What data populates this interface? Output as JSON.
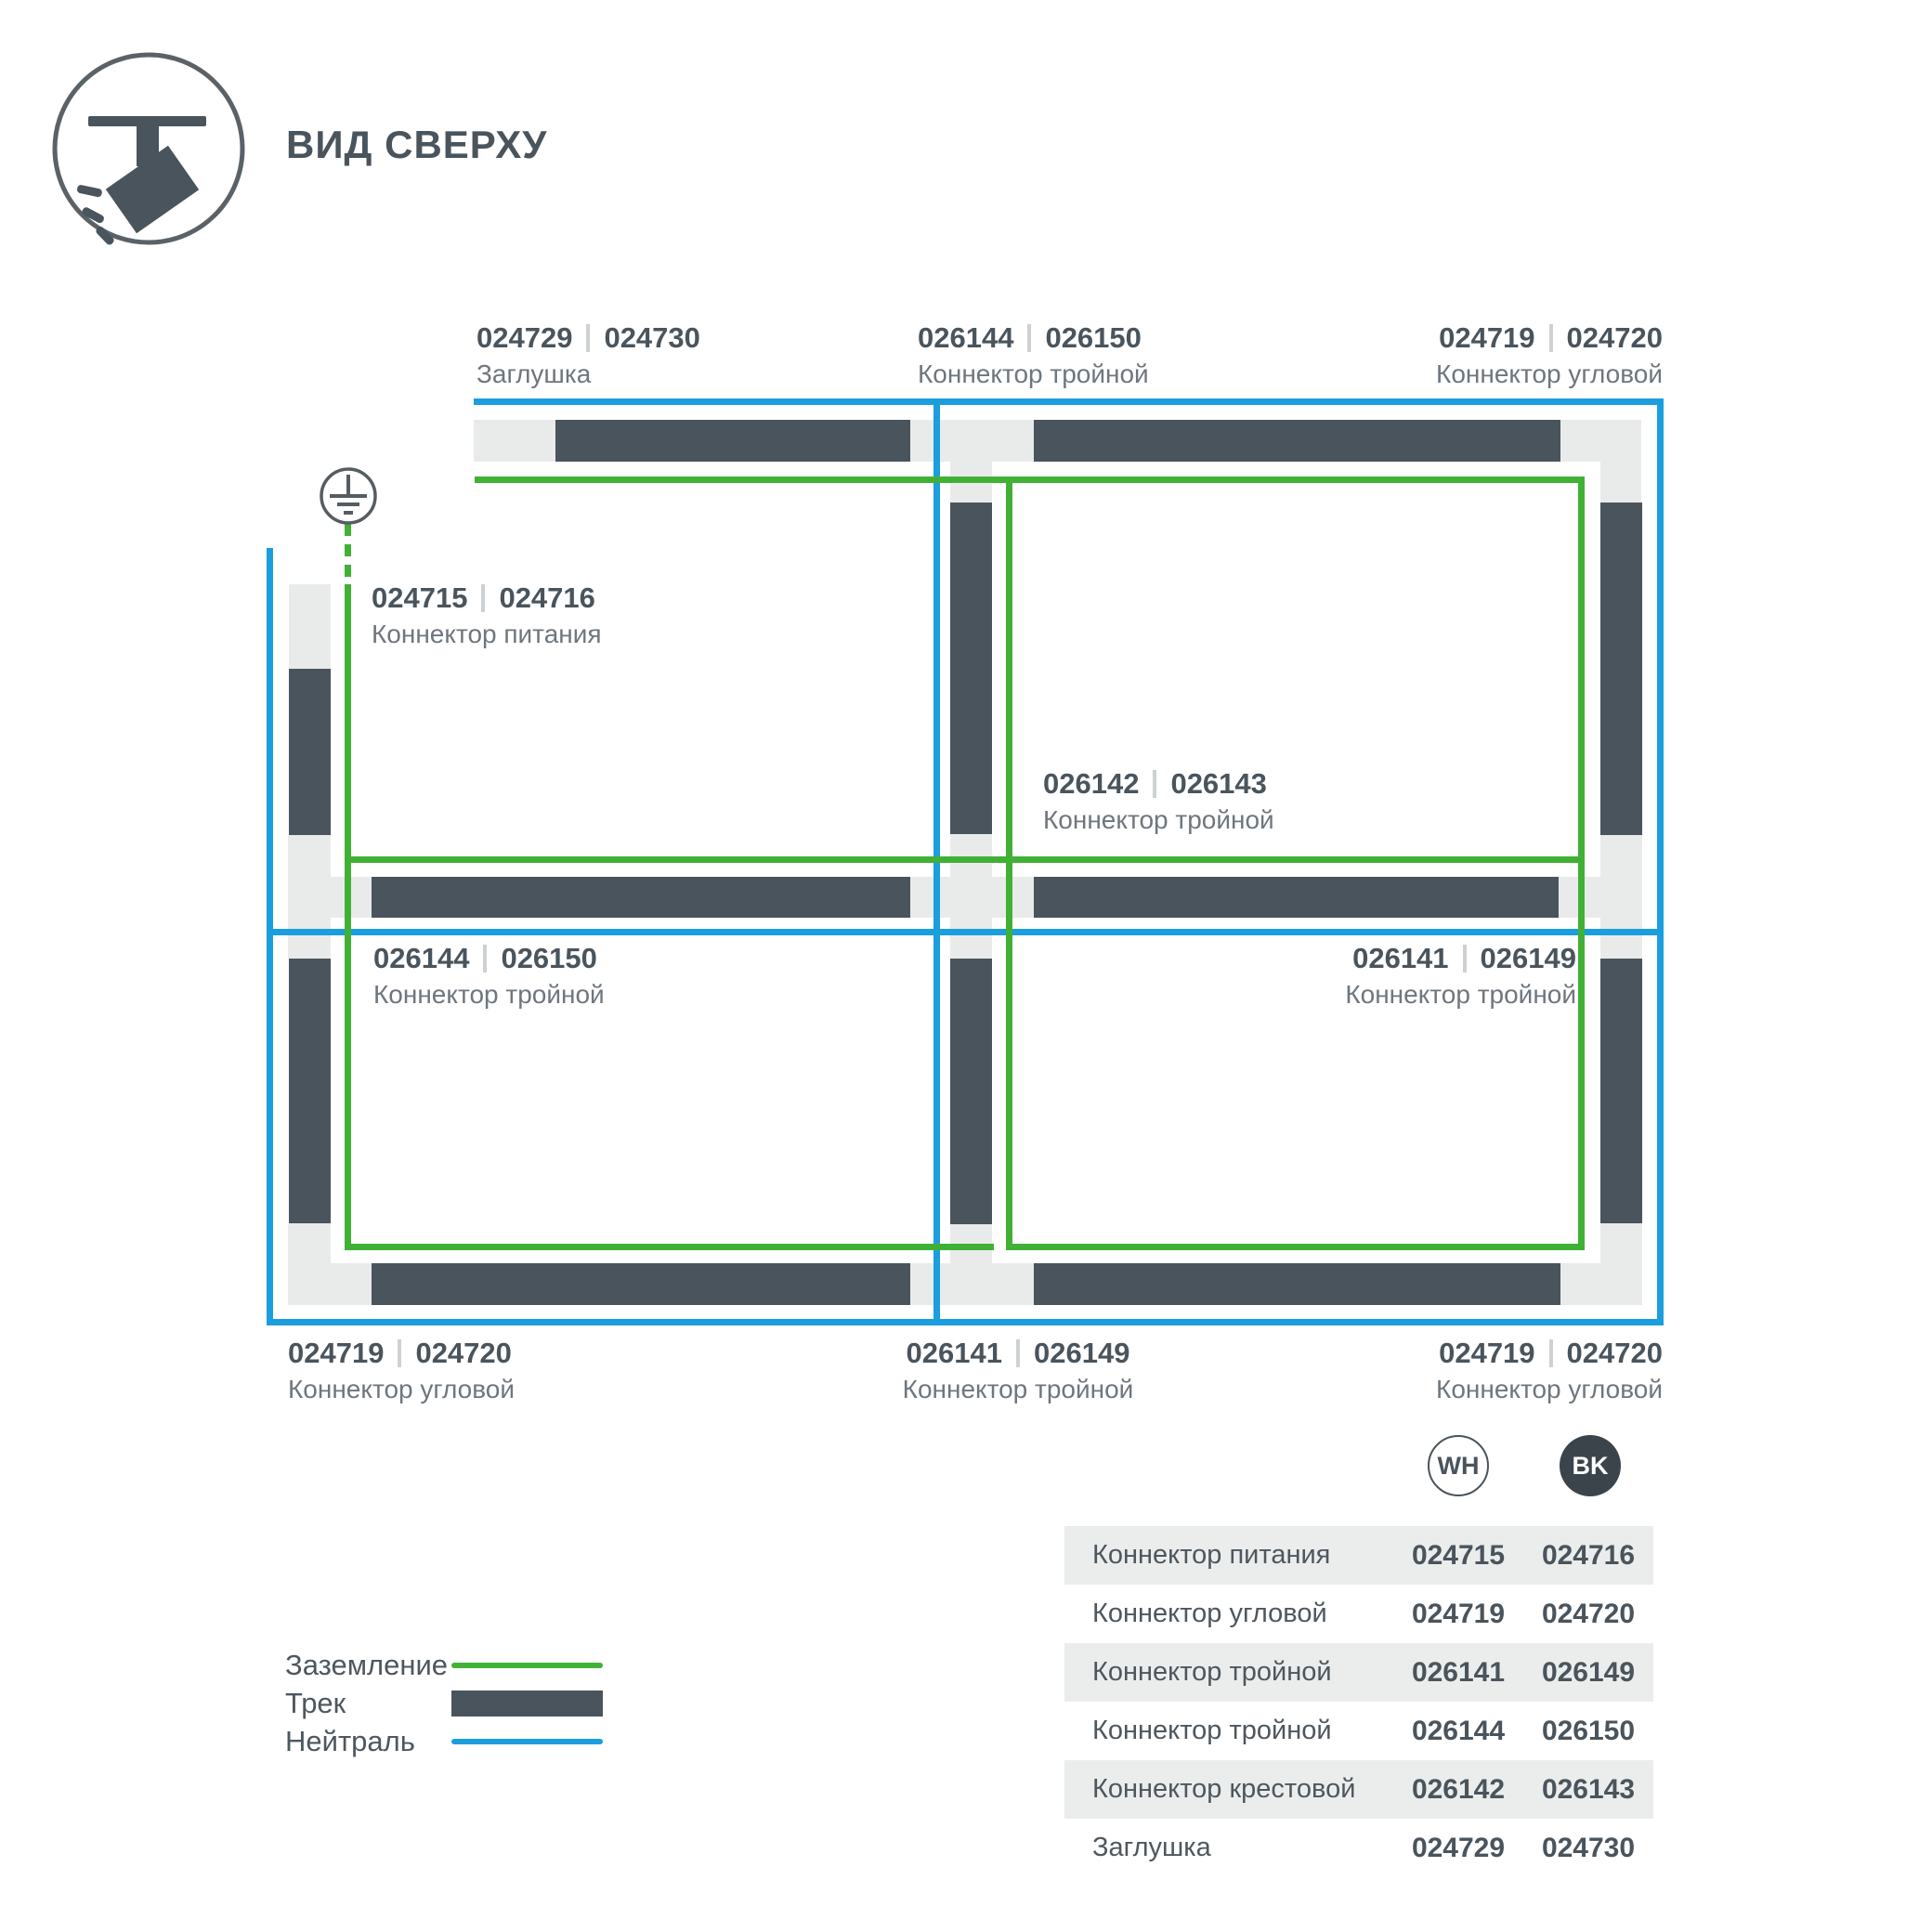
{
  "header": {
    "title": "ВИД СВЕРХУ"
  },
  "icons": {
    "spotlight": "track-spotlight-icon",
    "ground": "ground-earth-symbol"
  },
  "colors": {
    "track": "#4a545c",
    "connector": "#e9ebeb",
    "ground_line": "#41b136",
    "neutral_line": "#1b9edd",
    "accent_text": "#4a545c",
    "secondary_text": "#6e767e",
    "table_row_shade": "#ebeded",
    "bk_badge": "#3b444b"
  },
  "labels": {
    "cap_top": {
      "wh": "024729",
      "bk": "024730",
      "name": "Заглушка"
    },
    "tee_top": {
      "wh": "026144",
      "bk": "026150",
      "name": "Коннектор тройной"
    },
    "corner_top_right": {
      "wh": "024719",
      "bk": "024720",
      "name": "Коннектор угловой"
    },
    "power": {
      "wh": "024715",
      "bk": "024716",
      "name": "Коннектор питания"
    },
    "cross_center": {
      "wh": "026142",
      "bk": "026143",
      "name": "Коннектор тройной"
    },
    "tee_left": {
      "wh": "026144",
      "bk": "026150",
      "name": "Коннектор тройной"
    },
    "tee_right": {
      "wh": "026141",
      "bk": "026149",
      "name": "Коннектор тройной"
    },
    "corner_bottom_left": {
      "wh": "024719",
      "bk": "024720",
      "name": "Коннектор угловой"
    },
    "tee_bottom": {
      "wh": "026141",
      "bk": "026149",
      "name": "Коннектор тройной"
    },
    "corner_bottom_right": {
      "wh": "024719",
      "bk": "024720",
      "name": "Коннектор угловой"
    }
  },
  "legend": {
    "items": [
      {
        "label": "Заземление",
        "type": "ground"
      },
      {
        "label": "Трек",
        "type": "track"
      },
      {
        "label": "Нейтраль",
        "type": "neutral"
      }
    ]
  },
  "table": {
    "columns": [
      {
        "id": "wh",
        "label": "WH"
      },
      {
        "id": "bk",
        "label": "BK"
      }
    ],
    "rows": [
      {
        "name": "Коннектор питания",
        "wh": "024715",
        "bk": "024716"
      },
      {
        "name": "Коннектор угловой",
        "wh": "024719",
        "bk": "024720"
      },
      {
        "name": "Коннектор тройной",
        "wh": "026141",
        "bk": "026149"
      },
      {
        "name": "Коннектор тройной",
        "wh": "026144",
        "bk": "026150"
      },
      {
        "name": "Коннектор крестовой",
        "wh": "026142",
        "bk": "026143"
      },
      {
        "name": "Заглушка",
        "wh": "024729",
        "bk": "024730"
      }
    ]
  }
}
